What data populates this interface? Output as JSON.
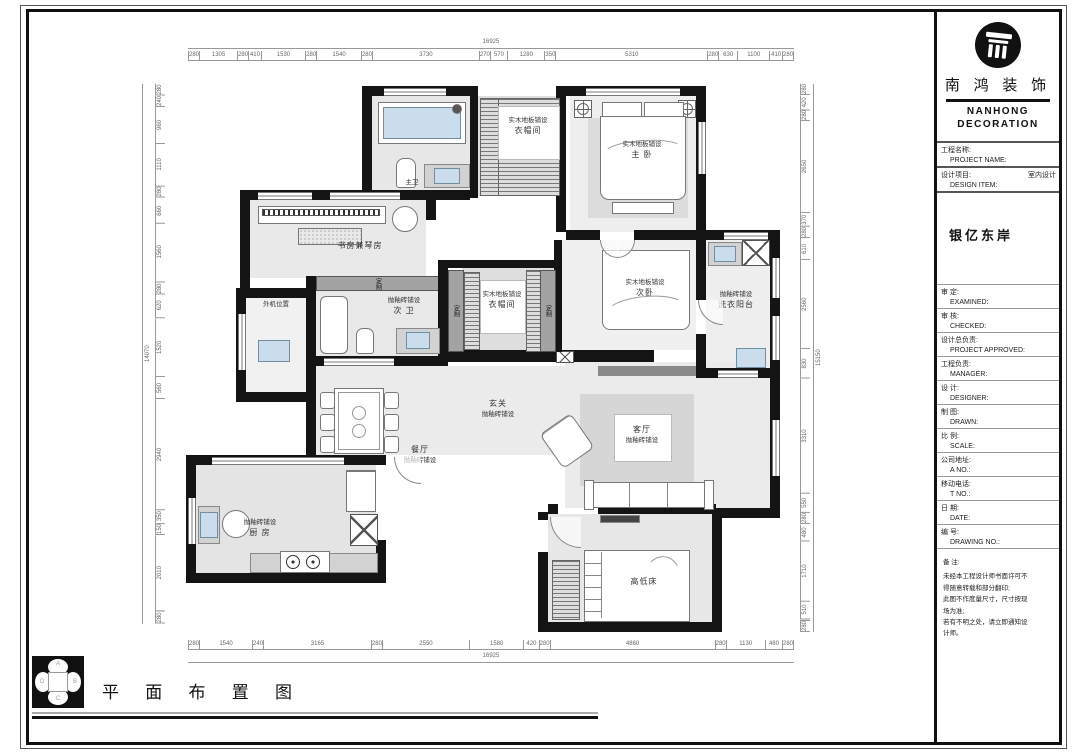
{
  "sheet": {
    "plan_title": "平 面 布 置 图",
    "compass": {
      "top": "A",
      "right": "B",
      "bottom": "C",
      "left": "D"
    }
  },
  "title_block": {
    "brand_cn": "南 鸿 装 饰",
    "brand_en_1": "NANHONG",
    "brand_en_2": "DECORATION",
    "project_name": "银亿东岸",
    "fields": [
      {
        "cn": "工程名称:",
        "en": "PROJECT NAME:",
        "value": ""
      },
      {
        "cn": "设计项目:",
        "en": "DESIGN ITEM:",
        "value": "室内设计"
      },
      {
        "cn": "审  定:",
        "en": "EXAMINED:",
        "value": ""
      },
      {
        "cn": "审  核:",
        "en": "CHECKED:",
        "value": ""
      },
      {
        "cn": "设计总负责:",
        "en": "PROJECT APPROVED:",
        "value": ""
      },
      {
        "cn": "工程负责:",
        "en": "MANAGER:",
        "value": ""
      },
      {
        "cn": "设  计:",
        "en": "DESIGNER:",
        "value": ""
      },
      {
        "cn": "制  图:",
        "en": "DRAWN:",
        "value": ""
      },
      {
        "cn": "比  例:",
        "en": "SCALE:",
        "value": ""
      },
      {
        "cn": "公司地址:",
        "en": "A  NO.:",
        "value": ""
      },
      {
        "cn": "移动电话:",
        "en": "T  NO.:",
        "value": ""
      },
      {
        "cn": "日  期:",
        "en": "DATE:",
        "value": ""
      },
      {
        "cn": "编  号:",
        "en": "DRAWING NO.:",
        "value": ""
      }
    ],
    "notes_label": "备 注:",
    "notes": [
      "未经本工程设计师书面许可不",
      "得随意转载和部分翻印;",
      "此图不作度量尺寸，尺寸按现",
      "场为准;",
      "若有不明之处，请立即通知设",
      "计师。"
    ]
  },
  "rooms": {
    "bath_master": {
      "name": "主卫"
    },
    "cloak1": {
      "material": "实木地板铺设",
      "name": "衣帽间"
    },
    "master": {
      "material": "实木地板铺设",
      "name": "主 卧"
    },
    "study": {
      "name": "书房兼琴房"
    },
    "outdoor": {
      "name": "外机位置"
    },
    "bath2": {
      "material": "抛釉砖铺设",
      "name": "次 卫"
    },
    "cloak2": {
      "material": "实木地板铺设",
      "name": "衣帽间"
    },
    "bed2": {
      "material": "实木地板铺设",
      "name": "次卧"
    },
    "laundry": {
      "material": "抛釉砖铺设",
      "name": "洗衣阳台"
    },
    "entry": {
      "name": "玄关",
      "material": "抛釉砖铺设"
    },
    "dining": {
      "name": "餐厅",
      "material": "抛釉砖铺设"
    },
    "living": {
      "name": "客厅",
      "material": "抛釉砖铺设"
    },
    "kitchen": {
      "material": "抛釉砖铺设",
      "name": "厨 房"
    },
    "bunk": {
      "name": "高低床"
    },
    "custom": "定制"
  },
  "dims": {
    "top": {
      "total": "16925",
      "segments": [
        "280",
        "1305",
        "280",
        "410",
        "1530",
        "280",
        "1540",
        "280",
        "3730",
        "270",
        "570",
        "1280",
        "350",
        "5310",
        "280",
        "630",
        "1100",
        "410",
        "280"
      ]
    },
    "bottom": {
      "total": "16925",
      "segments": [
        "280",
        "1540",
        "240",
        "3165",
        "280",
        "2550",
        "1580",
        "420",
        "280",
        "4860",
        "280",
        "1130",
        "480",
        "280"
      ]
    },
    "left": {
      "total": "14070",
      "segments": [
        "280",
        "240",
        "960",
        "1110",
        "280",
        "660",
        "1560",
        "280",
        "620",
        "1520",
        "560",
        "2940",
        "350",
        "150",
        "2010",
        "280"
      ]
    },
    "right": {
      "total": "15150",
      "segments": [
        "280",
        "420",
        "280",
        "2650",
        "370",
        "280",
        "610",
        "2560",
        "830",
        "3310",
        "550",
        "280",
        "480",
        "1710",
        "510",
        "280"
      ]
    }
  }
}
